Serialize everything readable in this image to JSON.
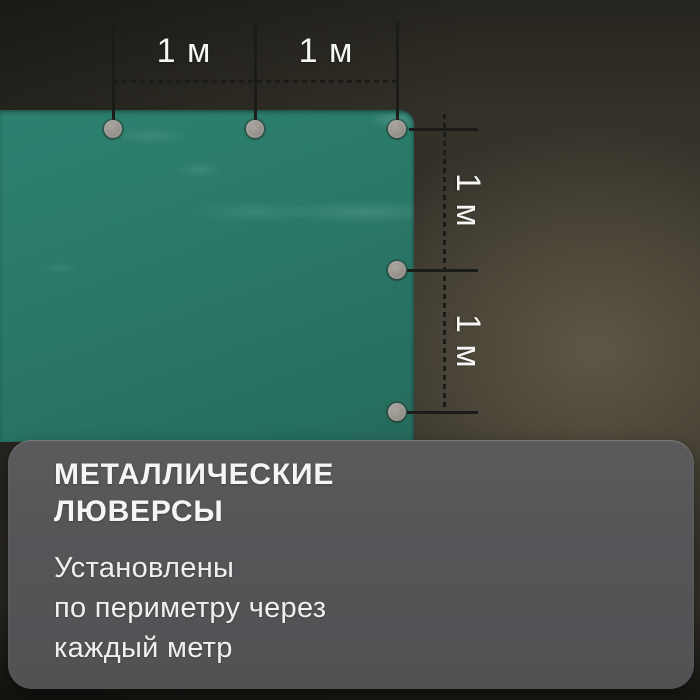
{
  "product_image": {
    "subject": "green tarpaulin with metal grommets",
    "measurements": {
      "top": [
        {
          "label": "1 м"
        },
        {
          "label": "1 м"
        }
      ],
      "right": [
        {
          "label": "1 м"
        },
        {
          "label": "1 м"
        }
      ]
    },
    "info_card": {
      "title_line1": "МЕТАЛЛИЧЕСКИЕ",
      "title_line2": "ЛЮВЕРСЫ",
      "desc_line1": "Установлены",
      "desc_line2": "по периметру через",
      "desc_line3": "каждый метр"
    }
  },
  "colors": {
    "tarp_green": "#2a7a68",
    "tarp_green_dark": "#256b5c",
    "card_gray": "#565558",
    "dimension_line": "#1b1b1a",
    "text_white": "#f5f5f4",
    "grommet_gray": "#96928b",
    "backdrop_base": "#343129"
  }
}
